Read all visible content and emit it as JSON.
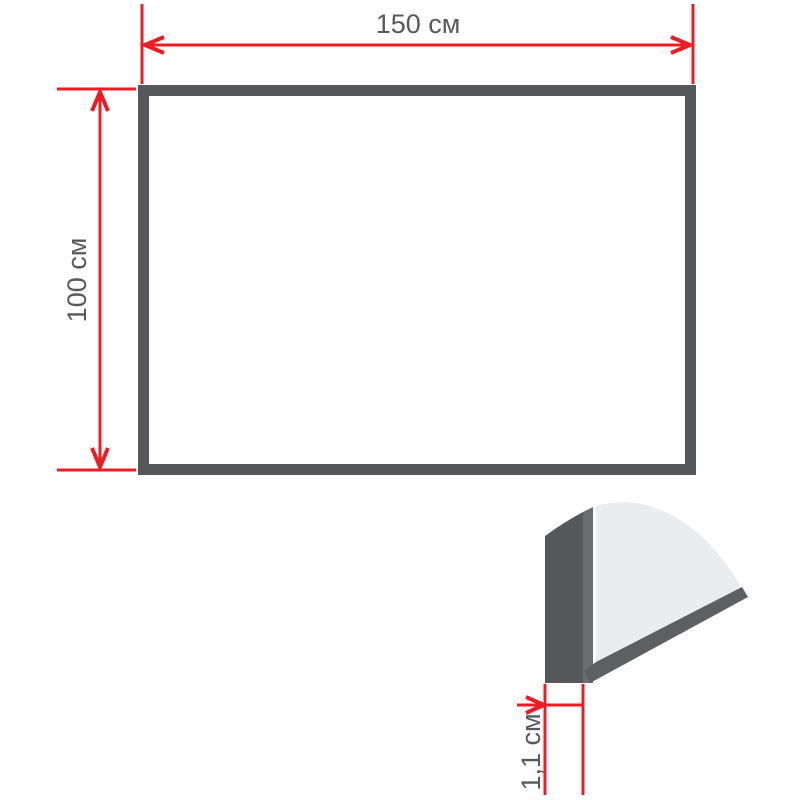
{
  "dimensions": {
    "width_cm": 150,
    "height_cm": 100,
    "thickness_cm": 1.1
  },
  "labels": {
    "width": "150 см",
    "height": "100 см",
    "thickness": "1,1 см"
  },
  "colors": {
    "dimension_line": "#EC1C24",
    "frame": "#57585C",
    "edge_band": "#6A6C70",
    "edge_strip": "#5D5F63",
    "surface": "#EBECEE",
    "board_face": "#FFFFFF",
    "label_text": "#58595B"
  }
}
